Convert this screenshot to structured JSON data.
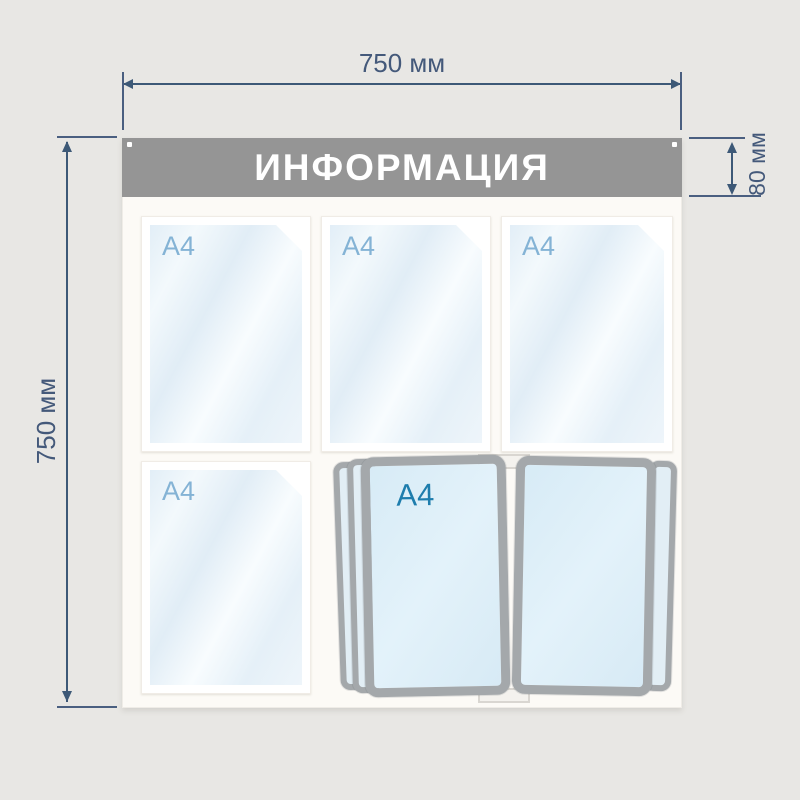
{
  "product": {
    "title": "ИНФОРМАЦИЯ",
    "type": "information-stand",
    "pockets": [
      {
        "label": "A4"
      },
      {
        "label": "A4"
      },
      {
        "label": "A4"
      },
      {
        "label": "A4"
      }
    ],
    "flip_system": {
      "label": "A4",
      "visible_pages": 2
    }
  },
  "dimensions": {
    "width": "750 мм",
    "height": "750 мм",
    "header_height": "80 мм"
  },
  "colors": {
    "page_background": "#e8e7e4",
    "board_background": "#fcfaf6",
    "header_background": "#959595",
    "header_text": "#ffffff",
    "pocket_label_blue": "#84b3d5",
    "flip_label_blue": "#1e7dad",
    "frame_gray": "#a4a8ab",
    "dimension_blue": "#3d5977"
  }
}
